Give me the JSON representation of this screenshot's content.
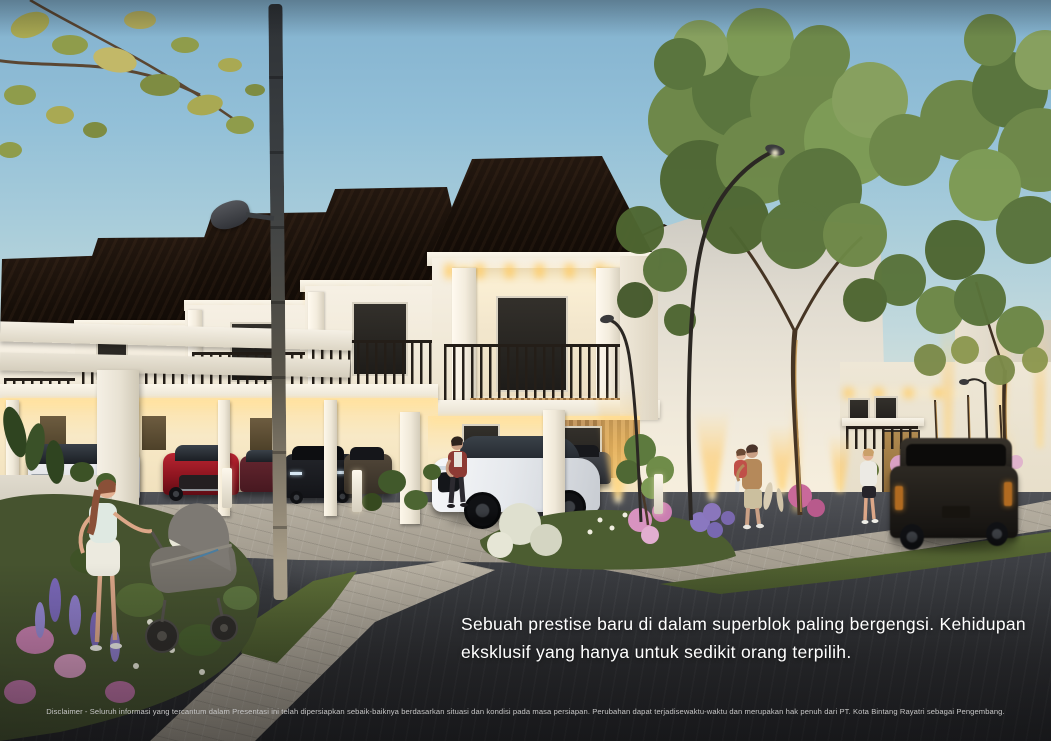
{
  "overlay": {
    "tagline": {
      "line1": "Sebuah prestise baru di dalam superblok paling bergengsi. Kehidupan",
      "line2": "eksklusif yang hanya untuk sedikit orang terpilih."
    },
    "disclaimer": "Disclaimer - Seluruh informasi yang tercantum dalam Presentasi ini telah dipersiapkan sebaik-baiknya berdasarkan situasi dan kondisi pada masa persiapan. Perubahan dapat terjadisewaktu-waktu dan merupakan hak penuh dari PT. Kota Bintang Rayatri sebagai Pengembang."
  },
  "scene": {
    "setting": "Dusk architectural rendering of a row of two-storey townhouses with black shingle mansard roofs, white facades and warm accent lighting",
    "developer_in_disclaimer": "PT. Kota Bintang Rayatri",
    "vehicles": [
      "white MPV in carport",
      "red SUV in carport",
      "maroon car in carport",
      "black SUV in carport",
      "bronze SUV in carport",
      "white electric SUV in carport",
      "gray car in carport",
      "black SUV driving on road"
    ],
    "people": [
      "woman pushing a stroller",
      "man standing beside white car",
      "man holding a child",
      "woman in white hoodie"
    ],
    "lighting": [
      "curved street lamps",
      "tall street light pole",
      "warm wall up-lights",
      "under-eave facade lights"
    ]
  },
  "palette": {
    "sky_top": "#82b1ce",
    "sky_horizon": "#f0ead8",
    "roof": "#170f09",
    "facade": "#f3eee3",
    "warm_light": "#ffd98a",
    "road": "#37393d",
    "tagline_text": "#ffffff",
    "disclaimer_text": "#c6c6c6"
  }
}
